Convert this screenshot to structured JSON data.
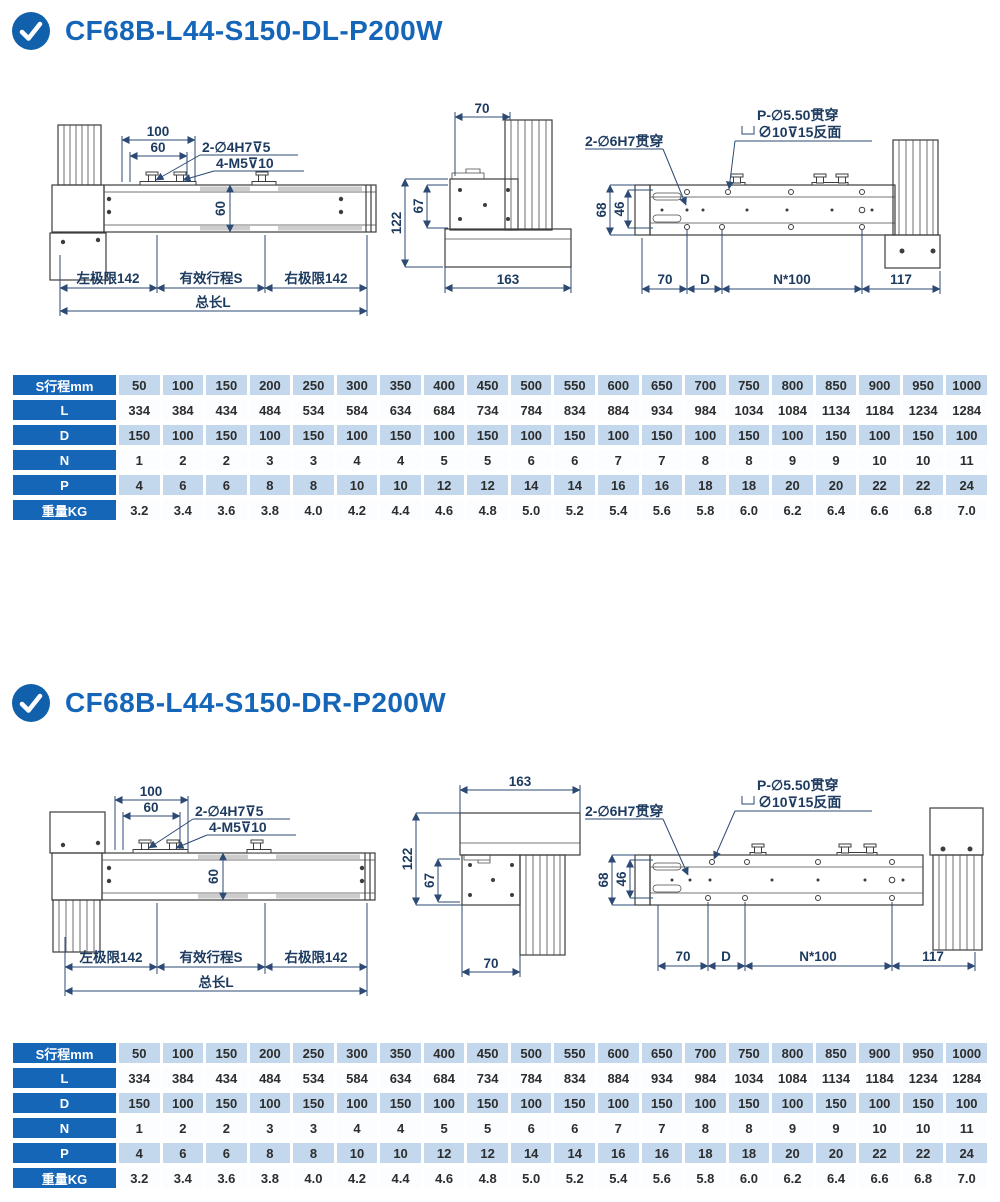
{
  "colors": {
    "brand_blue": "#1565b8",
    "table_header_blue": "#1566b7",
    "row_light_blue": "#c3d8ed",
    "dim_text_navy": "#1d3a5f"
  },
  "sections": [
    {
      "title": "CF68B-L44-S150-DL-P200W",
      "drawings": {
        "side": {
          "dim_100": "100",
          "dim_60_top": "60",
          "ann_holes": "2-∅4H7⊽5",
          "ann_screws": "4-M5⊽10",
          "dim_60_body": "60",
          "left_limit": "左极限142",
          "stroke_label": "有效行程S",
          "right_limit": "右极限142",
          "total_length": "总长L"
        },
        "end": {
          "dim_70": "70",
          "dim_122": "122",
          "dim_67": "67",
          "dim_163": "163"
        },
        "top": {
          "ann_side_holes": "2-∅6H7贯穿",
          "ann_p_holes": "P-∅5.50贯穿",
          "ann_cbore": "∅10⊽15反面",
          "dim_68": "68",
          "dim_46": "46",
          "dim_70": "70",
          "dim_d": "D",
          "dim_pitch": "N*100",
          "dim_117": "117"
        }
      },
      "table": {
        "rows": [
          {
            "label": "S行程mm",
            "values": [
              "50",
              "100",
              "150",
              "200",
              "250",
              "300",
              "350",
              "400",
              "450",
              "500",
              "550",
              "600",
              "650",
              "700",
              "750",
              "800",
              "850",
              "900",
              "950",
              "1000"
            ]
          },
          {
            "label": "L",
            "values": [
              "334",
              "384",
              "434",
              "484",
              "534",
              "584",
              "634",
              "684",
              "734",
              "784",
              "834",
              "884",
              "934",
              "984",
              "1034",
              "1084",
              "1134",
              "1184",
              "1234",
              "1284"
            ]
          },
          {
            "label": "D",
            "values": [
              "150",
              "100",
              "150",
              "100",
              "150",
              "100",
              "150",
              "100",
              "150",
              "100",
              "150",
              "100",
              "150",
              "100",
              "150",
              "100",
              "150",
              "100",
              "150",
              "100"
            ]
          },
          {
            "label": "N",
            "values": [
              "1",
              "2",
              "2",
              "3",
              "3",
              "4",
              "4",
              "5",
              "5",
              "6",
              "6",
              "7",
              "7",
              "8",
              "8",
              "9",
              "9",
              "10",
              "10",
              "11"
            ]
          },
          {
            "label": "P",
            "values": [
              "4",
              "6",
              "6",
              "8",
              "8",
              "10",
              "10",
              "12",
              "12",
              "14",
              "14",
              "16",
              "16",
              "18",
              "18",
              "20",
              "20",
              "22",
              "22",
              "24"
            ]
          },
          {
            "label": "重量KG",
            "values": [
              "3.2",
              "3.4",
              "3.6",
              "3.8",
              "4.0",
              "4.2",
              "4.4",
              "4.6",
              "4.8",
              "5.0",
              "5.2",
              "5.4",
              "5.6",
              "5.8",
              "6.0",
              "6.2",
              "6.4",
              "6.6",
              "6.8",
              "7.0"
            ]
          }
        ]
      }
    },
    {
      "title": "CF68B-L44-S150-DR-P200W",
      "drawings": {
        "side": {
          "dim_100": "100",
          "dim_60_top": "60",
          "ann_holes": "2-∅4H7⊽5",
          "ann_screws": "4-M5⊽10",
          "dim_60_body": "60",
          "left_limit": "左极限142",
          "stroke_label": "有效行程S",
          "right_limit": "右极限142",
          "total_length": "总长L"
        },
        "end": {
          "dim_163": "163",
          "dim_122": "122",
          "dim_67": "67",
          "dim_70": "70"
        },
        "top": {
          "ann_side_holes": "2-∅6H7贯穿",
          "ann_p_holes": "P-∅5.50贯穿",
          "ann_cbore": "∅10⊽15反面",
          "dim_68": "68",
          "dim_46": "46",
          "dim_70": "70",
          "dim_d": "D",
          "dim_pitch": "N*100",
          "dim_117": "117"
        }
      },
      "table": {
        "rows": [
          {
            "label": "S行程mm",
            "values": [
              "50",
              "100",
              "150",
              "200",
              "250",
              "300",
              "350",
              "400",
              "450",
              "500",
              "550",
              "600",
              "650",
              "700",
              "750",
              "800",
              "850",
              "900",
              "950",
              "1000"
            ]
          },
          {
            "label": "L",
            "values": [
              "334",
              "384",
              "434",
              "484",
              "534",
              "584",
              "634",
              "684",
              "734",
              "784",
              "834",
              "884",
              "934",
              "984",
              "1034",
              "1084",
              "1134",
              "1184",
              "1234",
              "1284"
            ]
          },
          {
            "label": "D",
            "values": [
              "150",
              "100",
              "150",
              "100",
              "150",
              "100",
              "150",
              "100",
              "150",
              "100",
              "150",
              "100",
              "150",
              "100",
              "150",
              "100",
              "150",
              "100",
              "150",
              "100"
            ]
          },
          {
            "label": "N",
            "values": [
              "1",
              "2",
              "2",
              "3",
              "3",
              "4",
              "4",
              "5",
              "5",
              "6",
              "6",
              "7",
              "7",
              "8",
              "8",
              "9",
              "9",
              "10",
              "10",
              "11"
            ]
          },
          {
            "label": "P",
            "values": [
              "4",
              "6",
              "6",
              "8",
              "8",
              "10",
              "10",
              "12",
              "12",
              "14",
              "14",
              "16",
              "16",
              "18",
              "18",
              "20",
              "20",
              "22",
              "22",
              "24"
            ]
          },
          {
            "label": "重量KG",
            "values": [
              "3.2",
              "3.4",
              "3.6",
              "3.8",
              "4.0",
              "4.2",
              "4.4",
              "4.6",
              "4.8",
              "5.0",
              "5.2",
              "5.4",
              "5.6",
              "5.8",
              "6.0",
              "6.2",
              "6.4",
              "6.6",
              "6.8",
              "7.0"
            ]
          }
        ]
      }
    }
  ]
}
